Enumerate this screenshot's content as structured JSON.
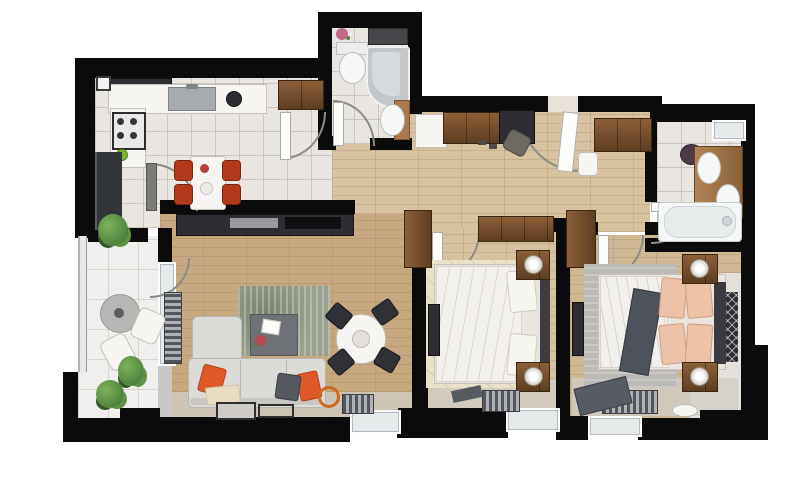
{
  "meta": {
    "title": "Apartment floor plan — top-down 3D render",
    "type": "floor-plan",
    "has_text_labels": false
  },
  "palette": {
    "wall": "#0b0b0b",
    "tile": "#e9e5e0",
    "balcony_tile": "#f0efed",
    "wood_hall": "#d7c3a0",
    "wood_living": "#c7a981",
    "wood_bed1": "#d6c2a0",
    "wood_bed2": "#cfb995",
    "rug_living": "#99a08d",
    "rug_bed1": "#eae1cb",
    "rug_bed2": "#bcbab7",
    "sofa": "#dcdbd7",
    "accent_orange": "#dd5a28",
    "chair_red": "#b23a1a",
    "furniture_brown": "#7a5531",
    "dark_appliance": "#2d2d32"
  },
  "rooms": [
    {
      "id": "kitchen-dining",
      "label": "Kitchen / Dining",
      "floor": "beige tile",
      "furniture": [
        "corner upper cabinet",
        "counter with sink",
        "cooktop with 4 burners",
        "fridge",
        "white dining table",
        "4 red chairs",
        "wardrobe in nook"
      ]
    },
    {
      "id": "bathroom-1",
      "label": "Bathroom 1 (top)",
      "floor": "tile",
      "furniture": [
        "toilet",
        "corner bathtub",
        "pedestal sink",
        "dark shelf",
        "small plant"
      ]
    },
    {
      "id": "hallway",
      "label": "Hallway / Entry",
      "floor": "wood",
      "furniture": [
        "white cabinet",
        "brown sideboard",
        "desk with chair",
        "entry door",
        "wardrobe",
        "white bench",
        "tall wardrobe"
      ]
    },
    {
      "id": "bathroom-2",
      "label": "Bathroom 2 (right)",
      "floor": "tile",
      "furniture": [
        "window",
        "laundry basket",
        "wood vanity with sink",
        "toilet",
        "bathtub"
      ]
    },
    {
      "id": "living-room",
      "label": "Living room",
      "floor": "wood",
      "furniture": [
        "TV media console",
        "area rug",
        "coffee table",
        "L-shaped sofa with orange pillows",
        "round dining table",
        "4 black chairs",
        "radiators",
        "floor mats",
        "orange basket"
      ]
    },
    {
      "id": "bedroom-1",
      "label": "Bedroom 1 (middle)",
      "floor": "wood",
      "furniture": [
        "double bed",
        "2 nightstands with lamps",
        "wardrobes",
        "TV",
        "cream rug",
        "radiator",
        "window"
      ]
    },
    {
      "id": "bedroom-2",
      "label": "Bedroom 2 (right)",
      "floor": "wood",
      "furniture": [
        "double bed with peach pillows",
        "dark throw",
        "2 nightstands with lamps",
        "wardrobe",
        "TV",
        "wall art panel",
        "gray rug",
        "radiator",
        "window"
      ]
    },
    {
      "id": "balcony",
      "label": "Balcony",
      "floor": "light tile",
      "furniture": [
        "round table",
        "2 white chairs",
        "3 plants",
        "glass railing"
      ]
    }
  ]
}
